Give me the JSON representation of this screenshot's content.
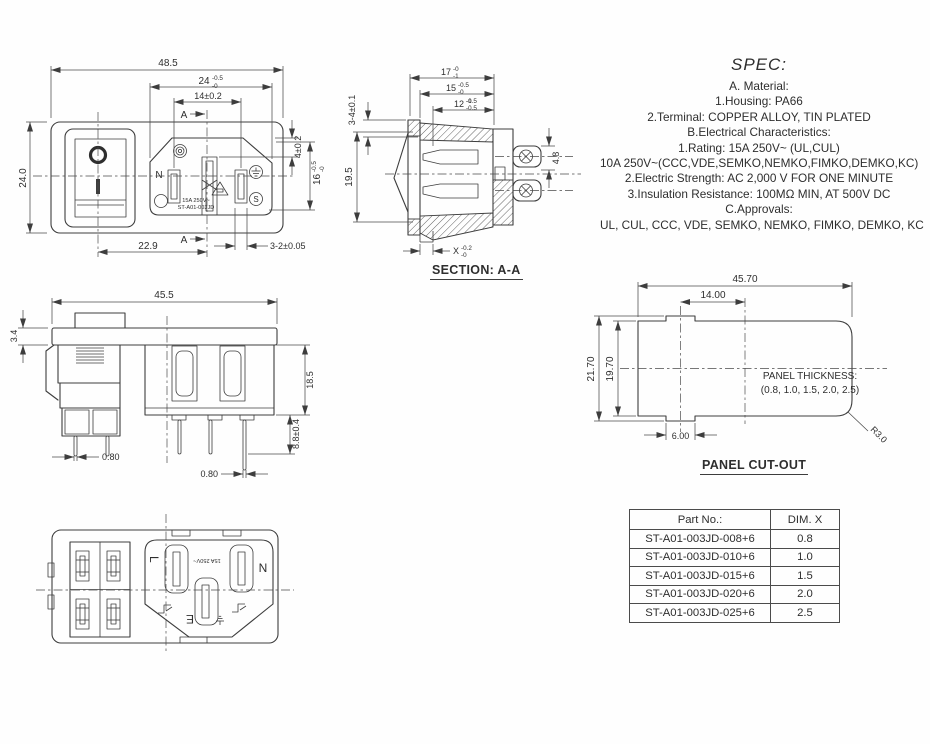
{
  "colors": {
    "ink": "#3d3d3d",
    "text": "#2e2e2e",
    "background": "#fefefe"
  },
  "views": {
    "front": {
      "dims": {
        "overall_w": "48.5",
        "d24": {
          "v": "24",
          "sup": "-0.5",
          "sub": "-0"
        },
        "d14": "14±0.2",
        "d4": "4±0.2",
        "overall_h": "24.0",
        "d16": {
          "v": "16",
          "sup": "-0.5",
          "sub": "-0"
        },
        "d229": "22.9",
        "d32": "3-2±0.05"
      },
      "section_marker_top": "A",
      "section_marker_bottom": "A",
      "markings": {
        "neutral": "N",
        "semko": "S",
        "rating": "15A 250V~",
        "part": "ST-A01-003JD"
      }
    },
    "section": {
      "label": "SECTION: A-A",
      "dims": {
        "d17": {
          "v": "17",
          "sup": "-0",
          "sub": "-1"
        },
        "d15": {
          "v": "15",
          "sup": "-0.5",
          "sub": "-0"
        },
        "d12": {
          "v": "12",
          "sup": "-1",
          "sub": "-0.5"
        },
        "d34": "3-4±0.1",
        "d195": "19.5",
        "d48": "4.8",
        "dx": {
          "v": "X",
          "sup": "-0.2",
          "sub": "-0"
        }
      }
    },
    "side": {
      "dims": {
        "overall_w": "45.5",
        "d34": "3.4",
        "d185": "18.5",
        "d88": "8.8±0.4",
        "pin1": "0.80",
        "pin2": "0.80"
      }
    },
    "cutout": {
      "label": "PANEL CUT-OUT",
      "dims": {
        "overall_w": "45.70",
        "inner_w": "14.00",
        "overall_h": "21.70",
        "inner_h": "19.70",
        "notch": "6.00",
        "radius": "R3.0"
      },
      "note1": "PANEL THICKNESS:",
      "note2": "(0.8, 1.0, 1.5, 2.0, 2.5)"
    },
    "rear": {
      "labels": {
        "line": "L",
        "neutral": "N",
        "earth": "E",
        "marking": "15A 250V~"
      }
    }
  },
  "spec": {
    "title": "SPEC:",
    "lines": [
      "A. Material:",
      "1.Housing: PA66",
      "2.Terminal: COPPER ALLOY, TIN PLATED",
      "B.Electrical Characteristics:",
      "1.Rating:  15A 250V~ (UL,CUL)",
      "10A 250V~(CCC,VDE,SEMKO,NEMKO,FIMKO,DEMKO,KC)",
      "2.Electric Strength: AC 2,000 V FOR ONE MINUTE",
      "3.Insulation Resistance: 100MΩ MIN, AT 500V DC",
      "C.Approvals:",
      "UL, CUL, CCC, VDE, SEMKO, NEMKO, FIMKO, DEMKO, KC"
    ]
  },
  "table": {
    "headers": [
      "Part No.:",
      "DIM. X"
    ],
    "rows": [
      [
        "ST-A01-003JD-008+6",
        "0.8"
      ],
      [
        "ST-A01-003JD-010+6",
        "1.0"
      ],
      [
        "ST-A01-003JD-015+6",
        "1.5"
      ],
      [
        "ST-A01-003JD-020+6",
        "2.0"
      ],
      [
        "ST-A01-003JD-025+6",
        "2.5"
      ]
    ]
  }
}
